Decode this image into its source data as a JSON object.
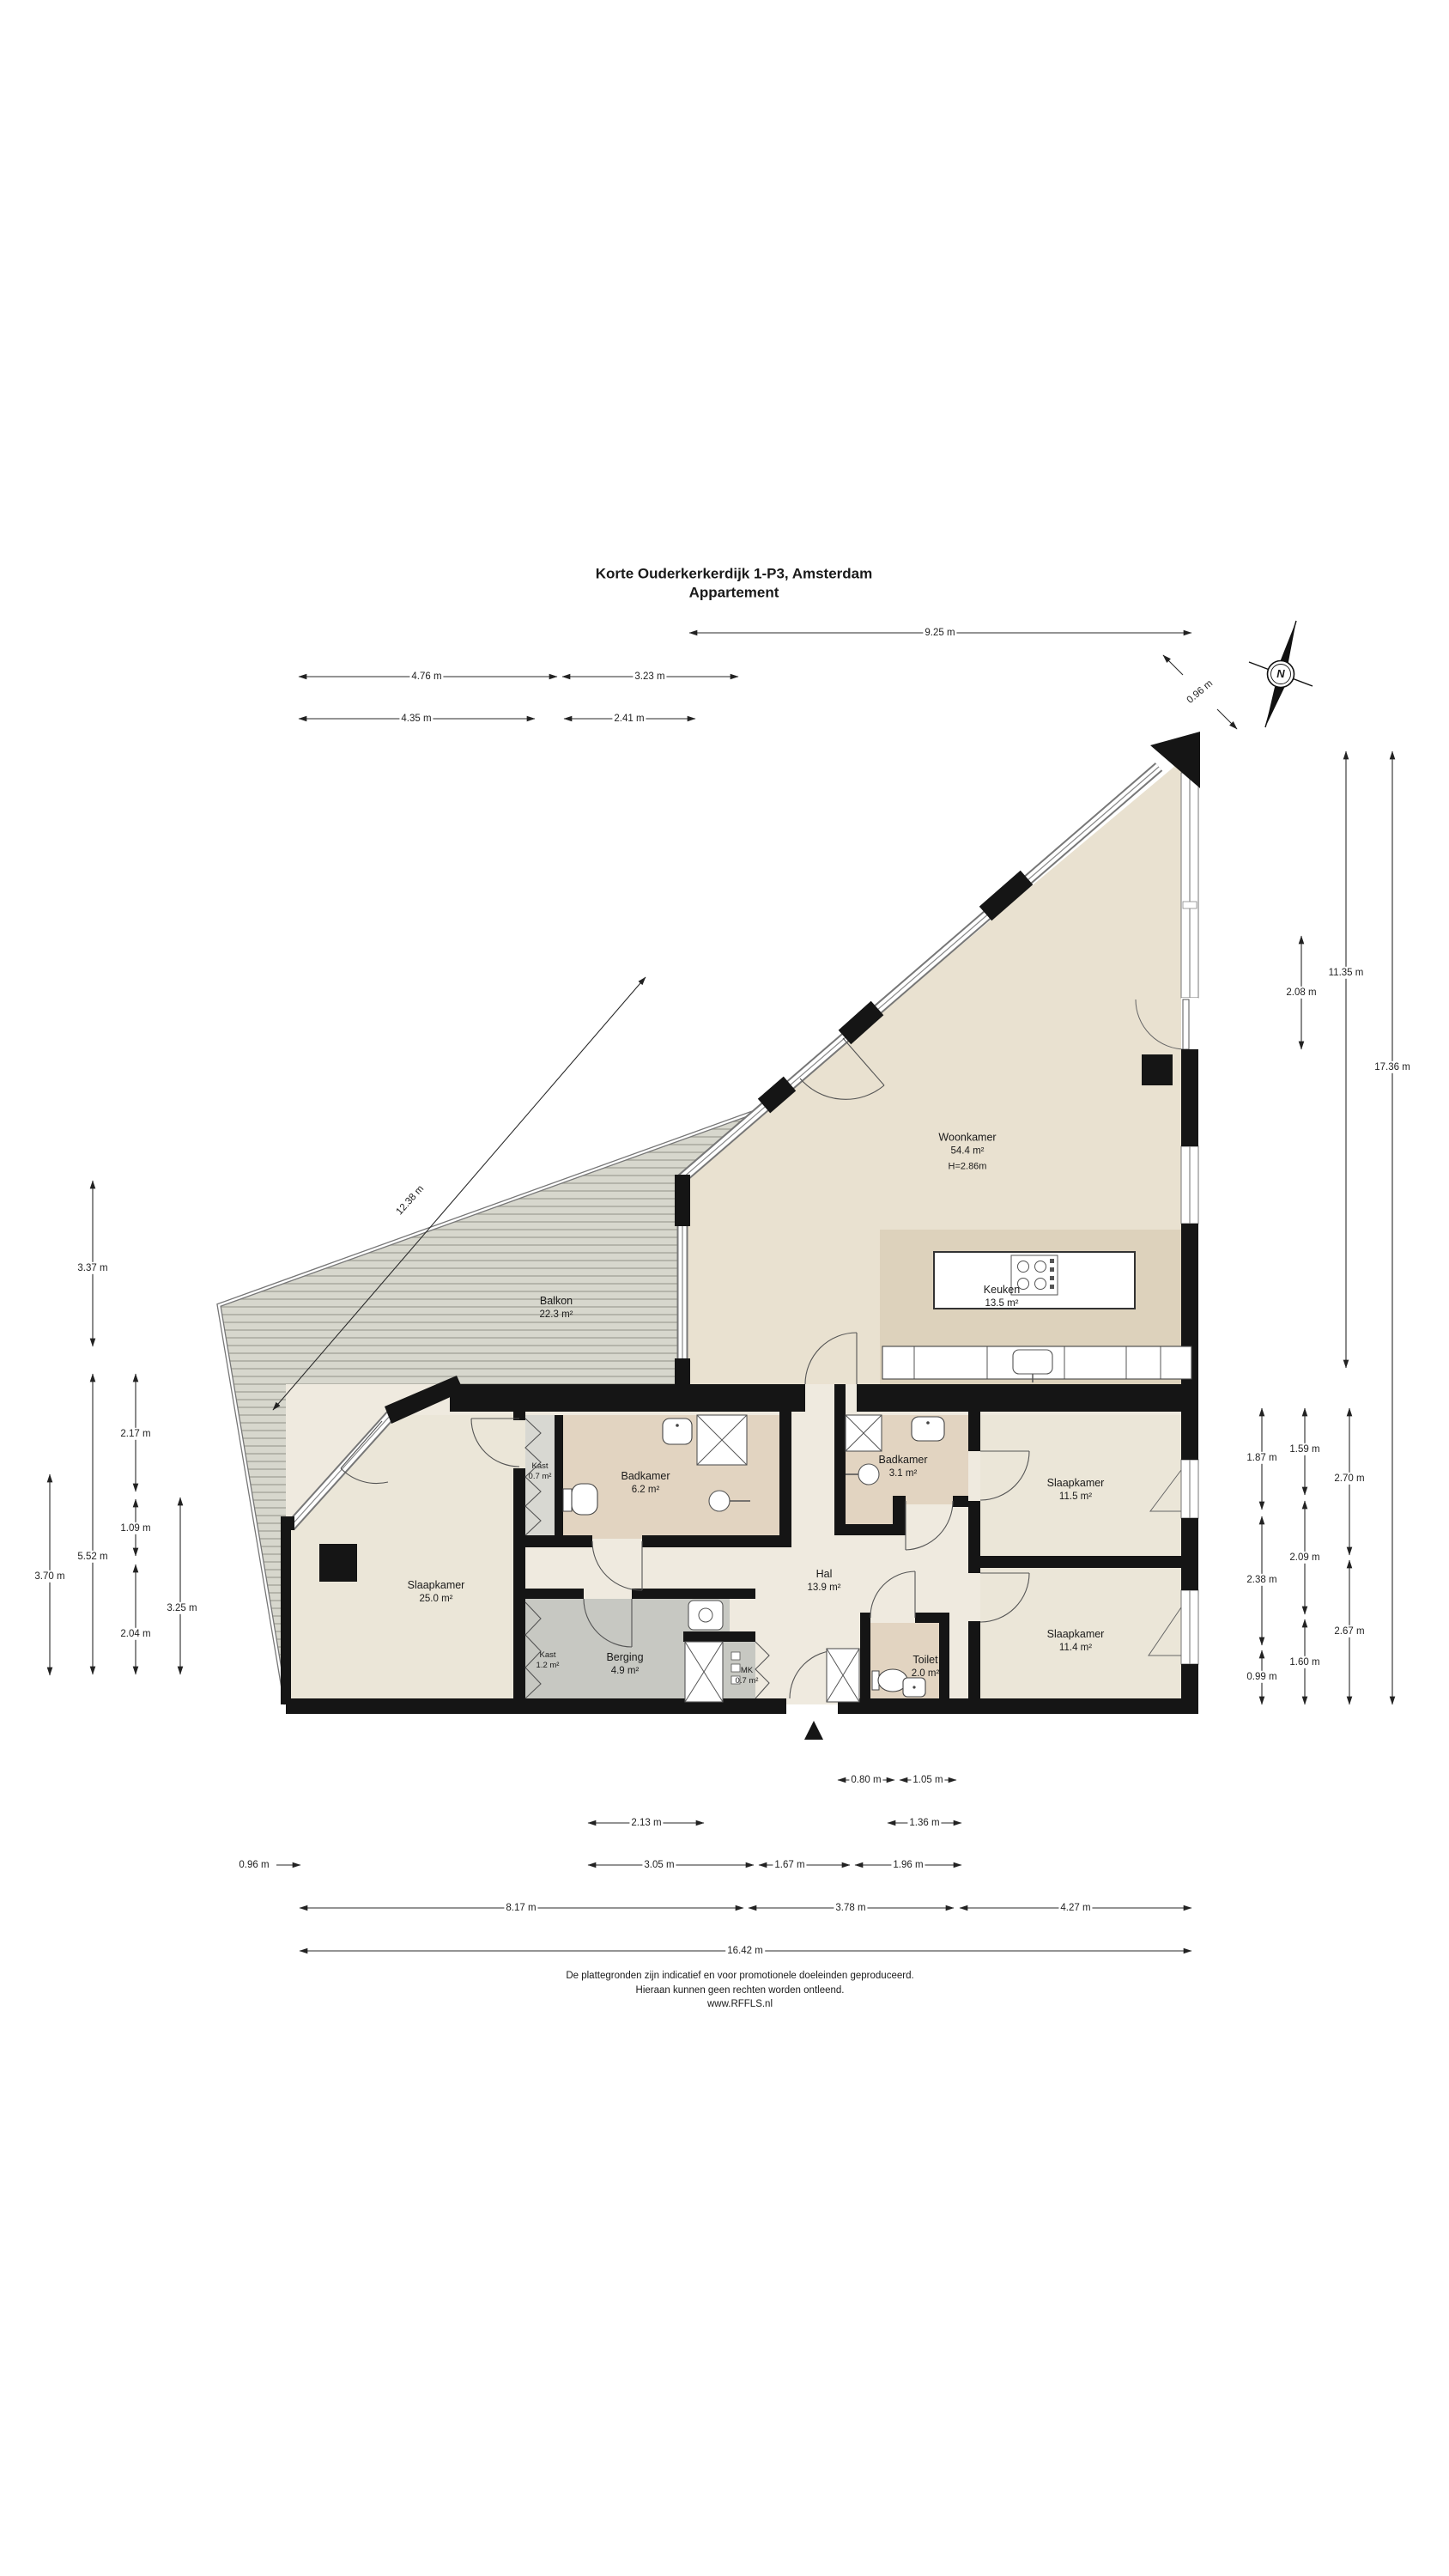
{
  "title": {
    "line1": "Korte Ouderkerkerdijk 1-P3, Amsterdam",
    "line2": "Appartement"
  },
  "compass": {
    "north_letter": "N"
  },
  "rooms": [
    {
      "name": "Woonkamer",
      "area": "54.4 m²",
      "height": "H=2.86m"
    },
    {
      "name": "Keuken",
      "area": "13.5 m²"
    },
    {
      "name": "Balkon",
      "area": "22.3 m²"
    },
    {
      "name": "Slaapkamer",
      "area": "25.0 m²"
    },
    {
      "name": "Kast",
      "area": "0.7 m²"
    },
    {
      "name": "Badkamer",
      "area": "6.2 m²"
    },
    {
      "name": "Badkamer",
      "area": "3.1 m²"
    },
    {
      "name": "Hal",
      "area": "13.9 m²"
    },
    {
      "name": "Slaapkamer",
      "area": "11.5 m²"
    },
    {
      "name": "Slaapkamer",
      "area": "11.4 m²"
    },
    {
      "name": "Kast",
      "area": "1.2 m²"
    },
    {
      "name": "Berging",
      "area": "4.9 m²"
    },
    {
      "name": "MK",
      "area": "0.7 m²"
    },
    {
      "name": "Toilet",
      "area": "2.0 m²"
    }
  ],
  "dims": [
    "9.25 m",
    "4.76 m",
    "3.23 m",
    "4.35 m",
    "2.41 m",
    "0.96 m",
    "12.38 m",
    "3.37 m",
    "5.52 m",
    "2.17 m",
    "1.09 m",
    "2.04 m",
    "3.25 m",
    "3.70 m",
    "2.08 m",
    "11.35 m",
    "17.36 m",
    "1.87 m",
    "2.38 m",
    "0.99 m",
    "1.59 m",
    "2.09 m",
    "1.60 m",
    "2.70 m",
    "2.67 m",
    "0.80 m",
    "1.05 m",
    "2.13 m",
    "1.36 m",
    "0.96 m",
    "3.05 m",
    "1.67 m",
    "1.96 m",
    "8.17 m",
    "3.78 m",
    "4.27 m",
    "16.42 m"
  ],
  "footer": {
    "line1": "De plattegronden zijn indicatief en voor promotionele doeleinden geproduceerd.",
    "line2": "Hieraan kunnen geen rechten worden ontleend.",
    "line3": "www.RFFLS.nl"
  }
}
